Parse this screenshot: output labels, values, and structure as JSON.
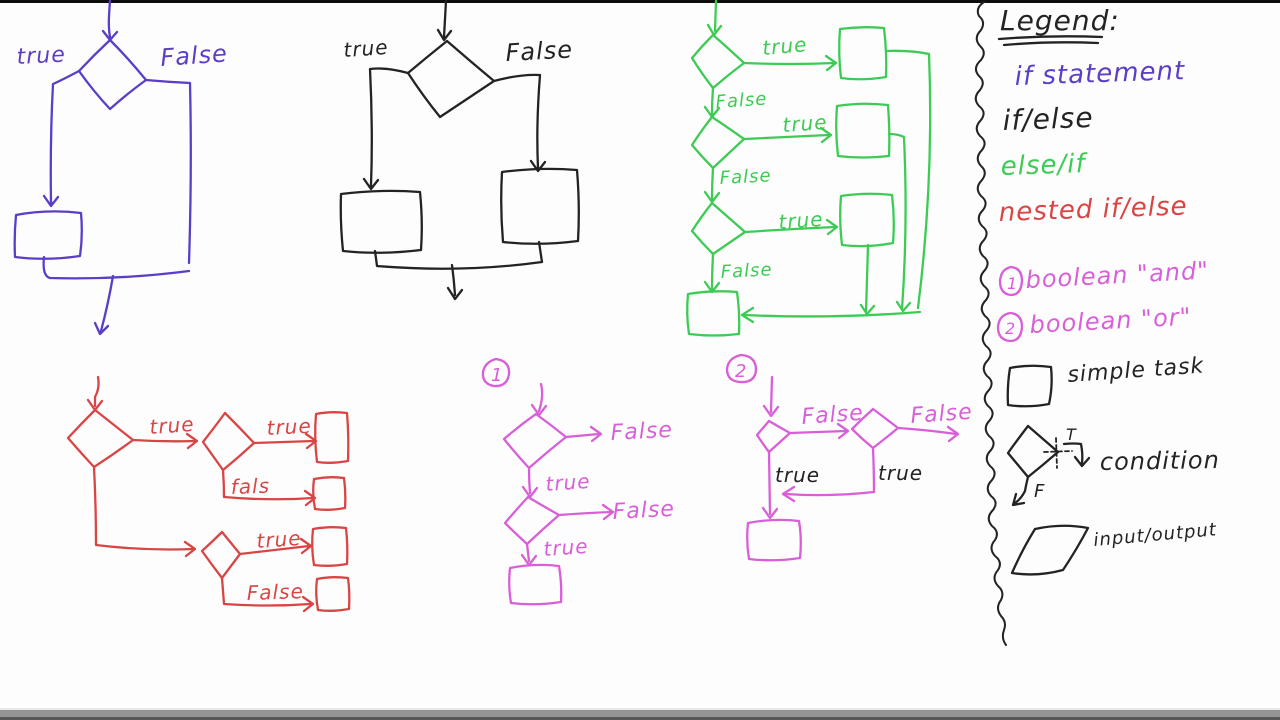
{
  "colors": {
    "purple": "#5a3ec8",
    "ink": "#232323",
    "green": "#3ecb55",
    "red": "#d94545",
    "magenta": "#d85fd8"
  },
  "charts": {
    "if_statement": {
      "true": "true",
      "false": "False"
    },
    "if_else": {
      "true": "true",
      "false": "False"
    },
    "else_if": {
      "true1": "true",
      "false1": "False",
      "true2": "true",
      "false2": "False",
      "true3": "true",
      "false3": "False"
    },
    "nested_if_else": {
      "true1": "true",
      "true2": "true",
      "fals": "fals",
      "true3": "true",
      "false": "False"
    },
    "boolean_and": {
      "number": "1",
      "false1": "False",
      "true1": "true",
      "false2": "False",
      "true2": "true"
    },
    "boolean_or": {
      "number": "2",
      "false1": "False",
      "false2": "False",
      "true1": "true",
      "true2": "true"
    }
  },
  "legend": {
    "title": "Legend:",
    "items": [
      {
        "label": "if statement"
      },
      {
        "label": "if/else"
      },
      {
        "label": "else/if"
      },
      {
        "label": "nested if/else"
      },
      {
        "number": "1",
        "label": "boolean \"and\""
      },
      {
        "number": "2",
        "label": "boolean \"or\""
      }
    ],
    "symbols": [
      {
        "label": "simple task"
      },
      {
        "label": "condition",
        "true_short": "T",
        "false_short": "F"
      },
      {
        "label": "input/output"
      }
    ]
  }
}
